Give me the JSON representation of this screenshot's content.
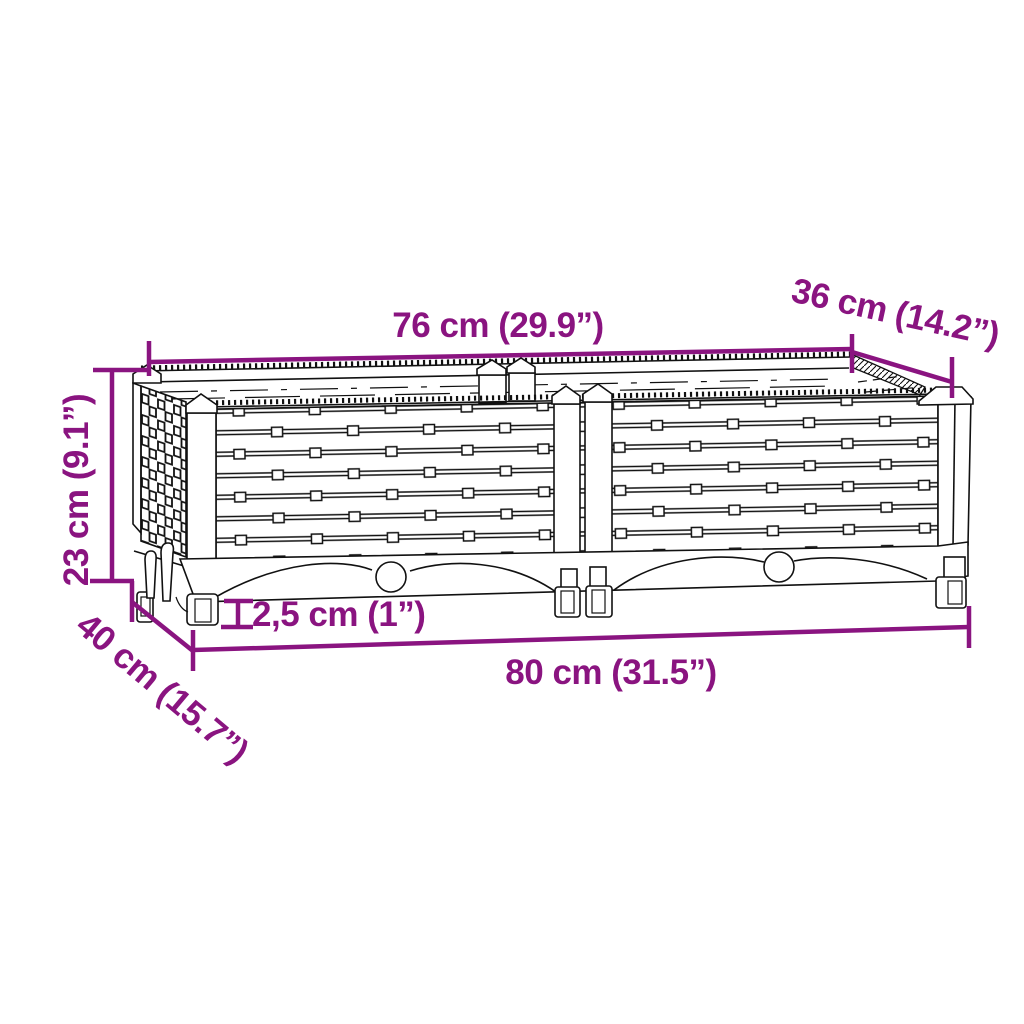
{
  "figure": {
    "colors": {
      "dimension_annotation": "#8A1480",
      "line_art": "#111111",
      "background": "#ffffff"
    }
  },
  "dimensions": {
    "top_width": "76 cm (29.9”)",
    "top_depth": "36 cm (14.2”)",
    "height": "23 cm (9.1”)",
    "bottom_depth": "40 cm (15.7”)",
    "ground_clearance": "2,5 cm (1”)",
    "bottom_width": "80 cm (31.5”)"
  }
}
